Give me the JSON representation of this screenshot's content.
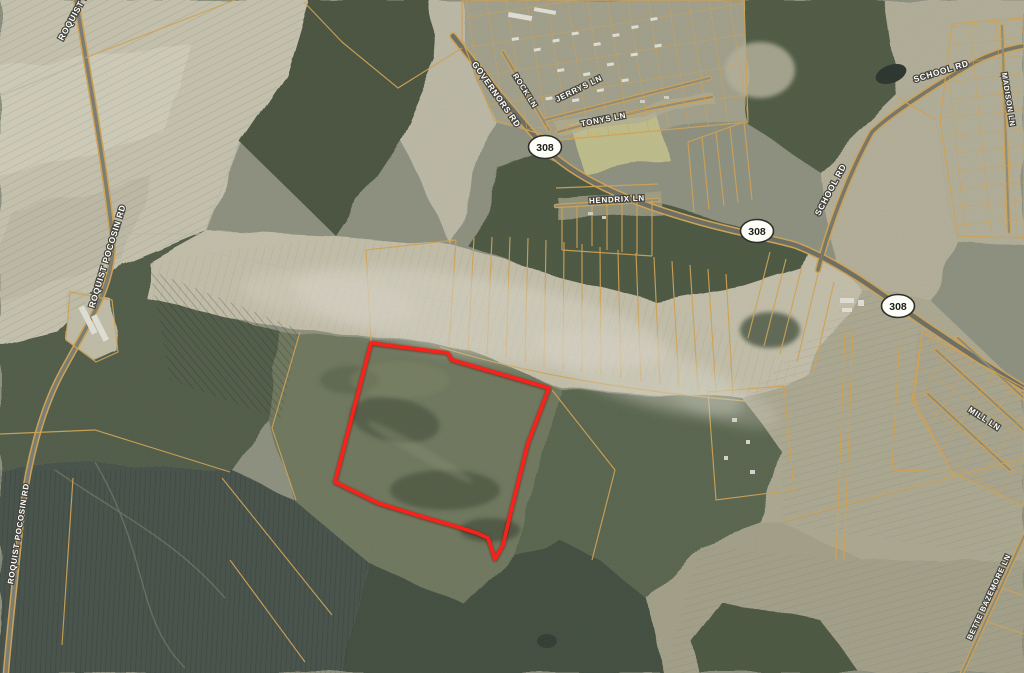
{
  "map": {
    "kind": "satellite-parcel-map",
    "road_labels": [
      {
        "id": "roquist-pocosin-rd-top",
        "text": "ROQUIST POCOSIN RD"
      },
      {
        "id": "roquist-pocosin-rd-mid",
        "text": "ROQUIST POCOSIN RD"
      },
      {
        "id": "roquist-pocosin-rd-bottom",
        "text": "ROQUIST POCOSIN RD"
      },
      {
        "id": "governors-rd",
        "text": "GOVERNORS RD"
      },
      {
        "id": "rock-ln",
        "text": "ROCK LN"
      },
      {
        "id": "jerrys-ln",
        "text": "JERRYS LN"
      },
      {
        "id": "tonys-ln",
        "text": "TONYS LN"
      },
      {
        "id": "hendrix-ln",
        "text": "HENDRIX LN"
      },
      {
        "id": "school-rd-upper",
        "text": "SCHOOL RD"
      },
      {
        "id": "school-rd-lower",
        "text": "SCHOOL RD"
      },
      {
        "id": "madison-ln",
        "text": "MADISON LN"
      },
      {
        "id": "mill-ln",
        "text": "MILL LN"
      },
      {
        "id": "bette-bazemore-ln",
        "text": "BETTE BAZEMORE LN"
      }
    ],
    "highway_shields": [
      {
        "route": "308"
      },
      {
        "route": "308"
      },
      {
        "route": "308"
      }
    ],
    "highlight_parcel": {
      "label": "subject-property-outline",
      "stroke": "#f8211a",
      "points": "371,343 448,353 452,360 549,388 528,443 511,511 503,545 495,559 488,538 477,533 458,527 420,516 378,503 335,482"
    },
    "colors": {
      "highlight_red": "#f8211a",
      "parcel_line_gold": "#d8a552",
      "shield_fill": "#fdfdf7",
      "shield_border": "#2e2e2a",
      "label_text": "#ffffff",
      "label_halo": "#45443c"
    }
  }
}
